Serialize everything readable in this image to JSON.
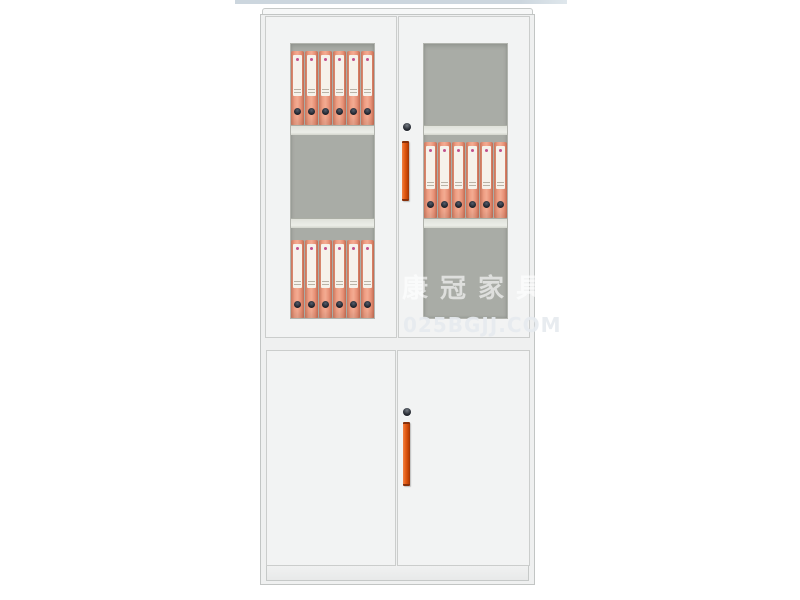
{
  "page": {
    "background": "#ffffff",
    "top_strip": {
      "color": "#ccd6de"
    }
  },
  "watermark": {
    "brand": "康冠家具",
    "url": "025BGJJ.COM"
  },
  "cabinet": {
    "glass_doors": 2,
    "solid_doors": 2,
    "locks": 2,
    "handles": 2,
    "binders_per_shelf": 6,
    "binder_shelves": [
      {
        "door": "upper-left",
        "position": "top",
        "count": 6
      },
      {
        "door": "upper-right",
        "position": "middle",
        "count": 6
      },
      {
        "door": "upper-left",
        "position": "bottom",
        "count": 6
      }
    ],
    "colors": {
      "body": "#eff0f0",
      "frame_line": "#cbcdcc",
      "glass_interior": "#a9aca6",
      "shelf": "#dfe1da",
      "binder": "#e89176",
      "binder_label": "#f6f2eb",
      "binder_hole": "#1e222b",
      "handle": "#e25a12",
      "lock": "#272b33"
    }
  }
}
